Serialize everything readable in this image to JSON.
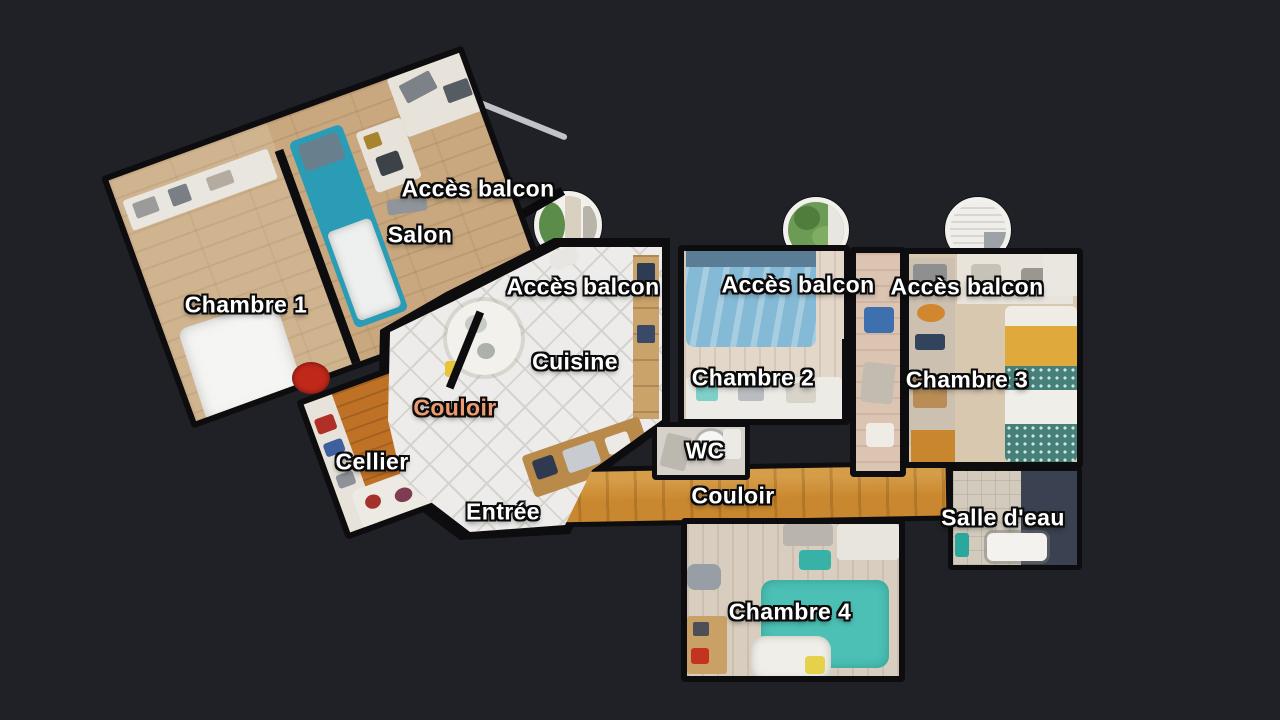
{
  "view": {
    "type": "3d-dollhouse-floorplan",
    "background": "#202126",
    "wall_color": "#0d0d10"
  },
  "labels": {
    "acces_balcon": "Accès balcon",
    "salon": "Salon",
    "chambre1": "Chambre 1",
    "cuisine": "Cuisine",
    "couloir": "Couloir",
    "cellier": "Cellier",
    "entree": "Entrée",
    "wc": "WC",
    "chambre2": "Chambre 2",
    "chambre3": "Chambre 3",
    "salle_eau": "Salle d'eau",
    "chambre4": "Chambre 4"
  },
  "label_style": {
    "default_color": "#ffffff",
    "highlight_color": "#ED9B70",
    "highlighted_label": "couloir",
    "outline_color": "#000000"
  },
  "balcony_portholes": [
    {
      "id": "salon-balcony",
      "view": "balcony doorway with plant"
    },
    {
      "id": "chambre2-balcony",
      "view": "green trees"
    },
    {
      "id": "chambre3-balcony",
      "view": "closed white shutters"
    }
  ],
  "palette": {
    "wood_light": "#c9a87f",
    "wood_orange": "#c9882f",
    "cellier_wood": "#bf7226",
    "tile_white": "#edecea",
    "bed_blue": "#85bad6",
    "bed_teal": "#4cc0b4",
    "sofa_teal": "#2b9cb5",
    "blanket_yellow": "#e0a93b",
    "slate_dark": "#3a4150"
  }
}
